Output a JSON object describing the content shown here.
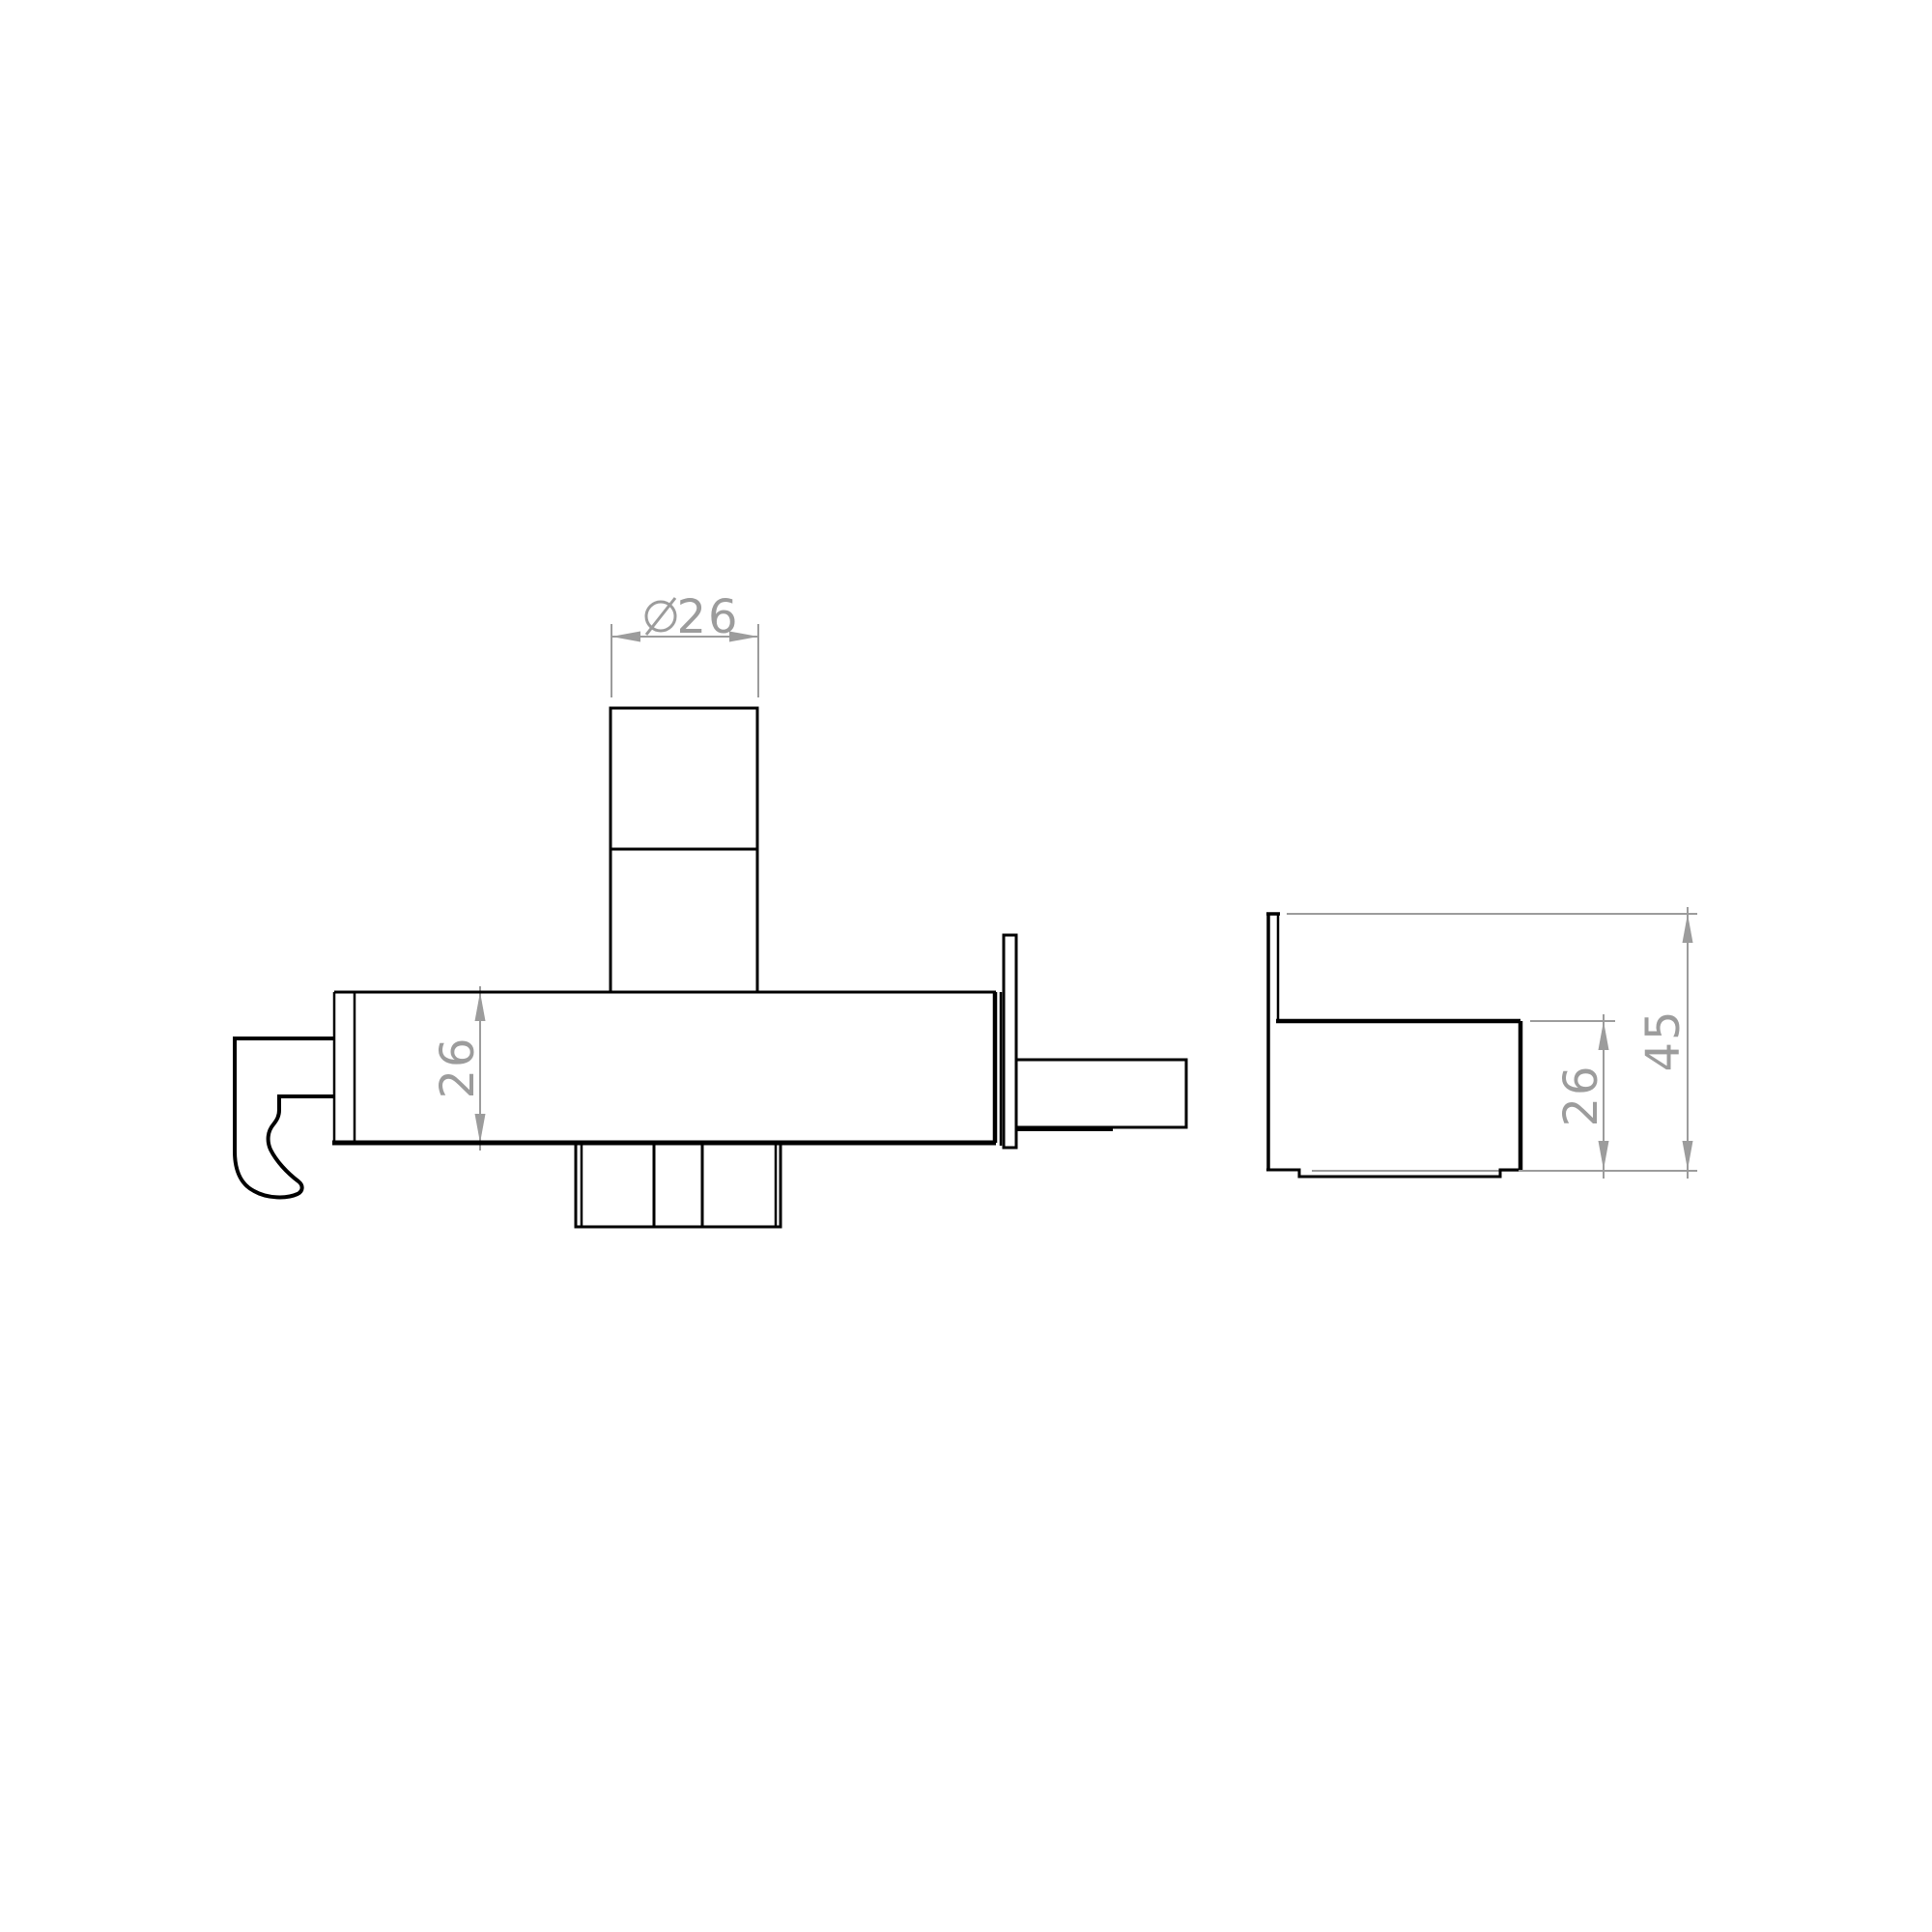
{
  "colors": {
    "background": "#ffffff",
    "outline": "#000000",
    "dimension": "#9c9c9c"
  },
  "front_view": {
    "diameter_dim": {
      "symbol": "∅",
      "value": "26"
    },
    "height_dim": {
      "value": "26"
    }
  },
  "side_view": {
    "depth_dim": {
      "value": "26"
    },
    "height_dim": {
      "value": "45"
    }
  }
}
